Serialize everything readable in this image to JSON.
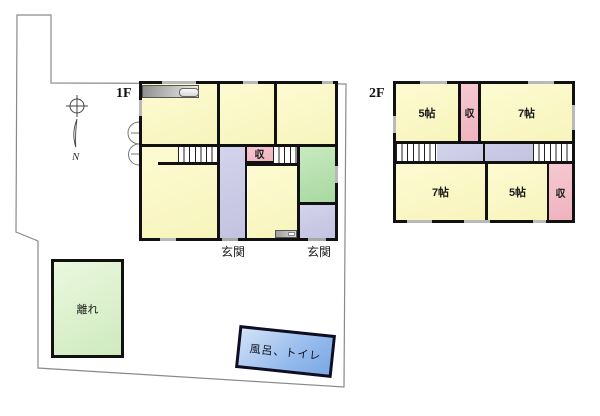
{
  "site": {
    "compass_label": "N",
    "boundary_color": "#8a8a8a"
  },
  "floor1": {
    "label": "1F",
    "storage_label": "収",
    "entrance_label_left": "玄関",
    "entrance_label_right": "玄関"
  },
  "floor2": {
    "label": "2F",
    "room_nw_label": "5帖",
    "storage_top_label": "収",
    "room_ne_label": "7帖",
    "room_sw_label": "7帖",
    "room_se_label": "5帖",
    "storage_se_label": "収"
  },
  "annex": {
    "label": "離れ"
  },
  "bath": {
    "label": "風呂、トイレ"
  },
  "colors": {
    "room_yellow": "#fbf9c8",
    "corridor_purple": "#cbcae6",
    "storage_pink": "#f2bfc9",
    "tatami_green": "#b7dfae",
    "annex_green": "#dff3d2",
    "bath_blue": "#8fb6e9",
    "wall": "#111111",
    "boundary": "#8a8a8a"
  }
}
